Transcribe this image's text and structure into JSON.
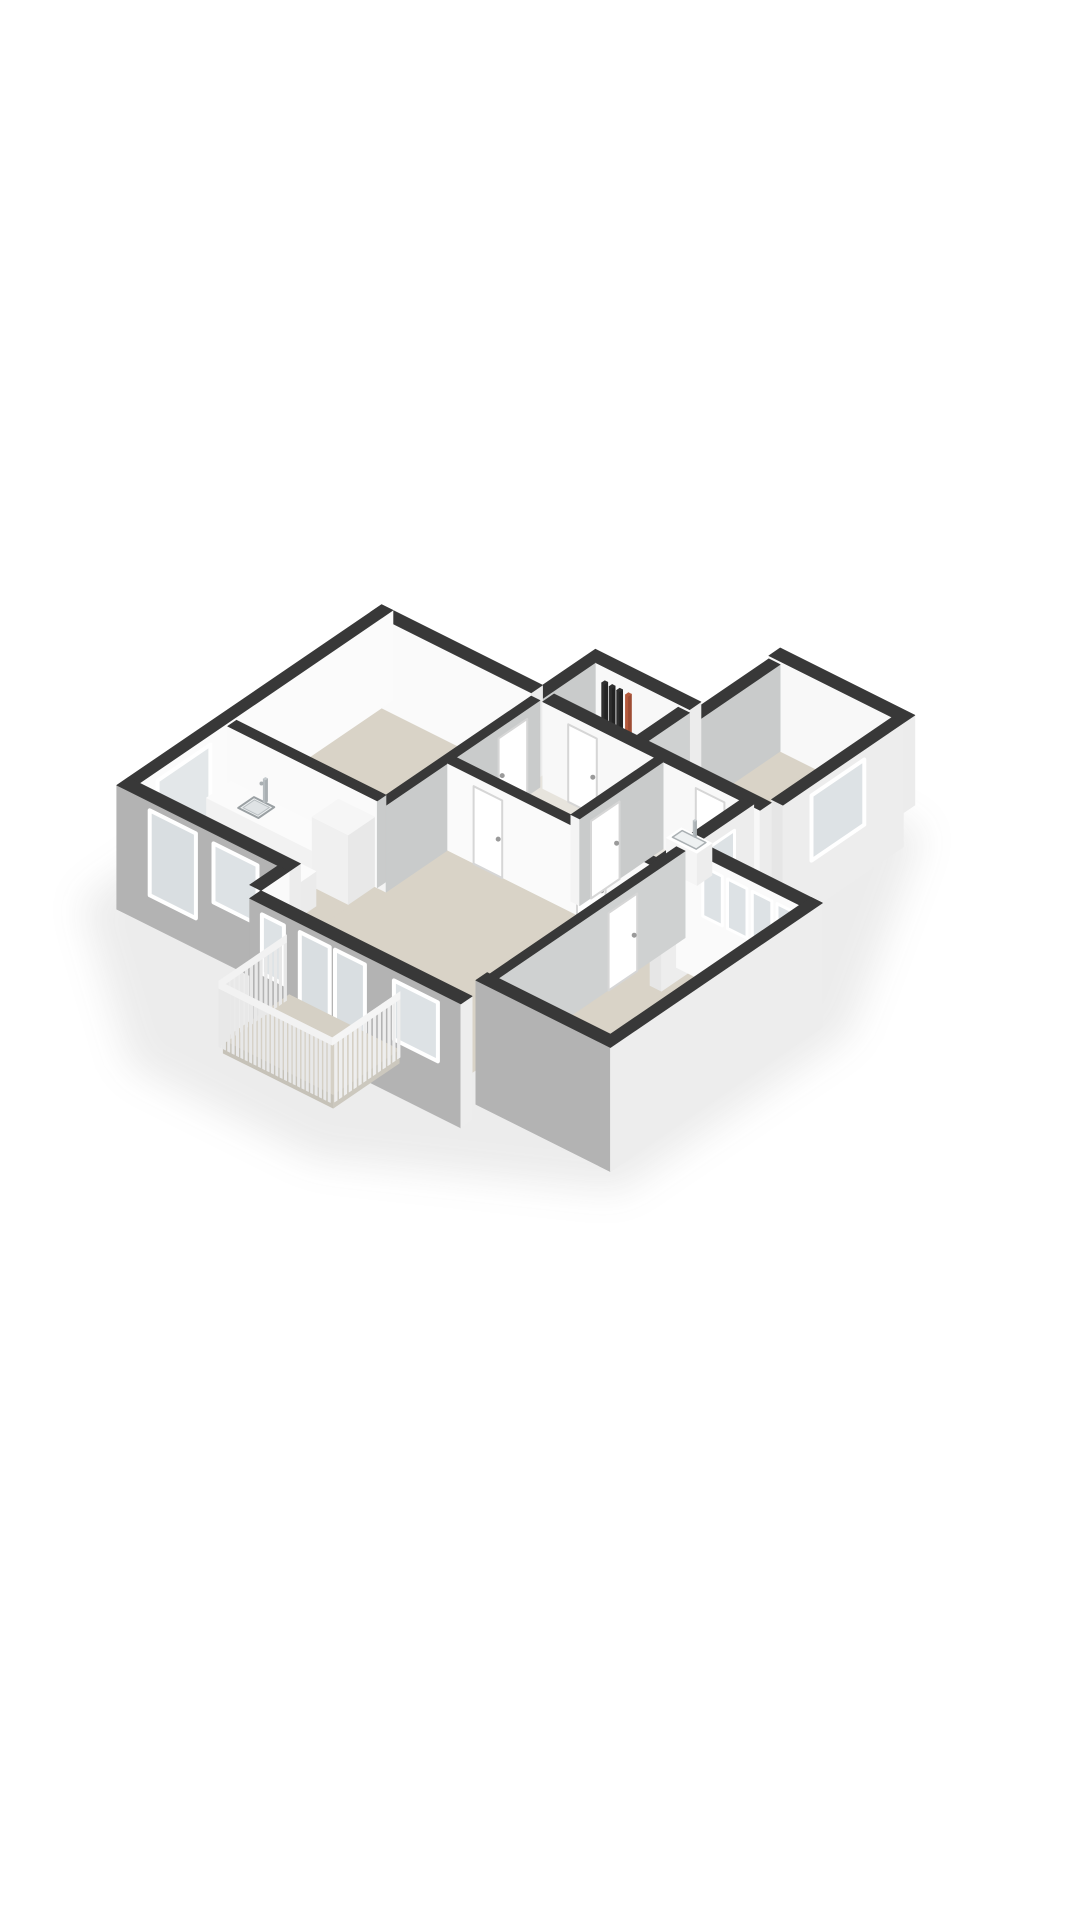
{
  "meta": {
    "description": "3D isometric cut-away floor plan render of an apartment, no text labels",
    "background": "#ffffff",
    "palette": {
      "wall_top": "#383838",
      "facade_south": "#b3b3b3",
      "facade_east": "#ededed",
      "interior_white": "#fafafa",
      "interior_gray": "#c9cbcb",
      "floor_beige": "#d9d3c7",
      "floor_light": "#e7e4dd",
      "glass": "#dde2e5",
      "cooktop": "#1e1e1e",
      "pipe_dark": "#2e2e2e",
      "pipe_orange": "#b3593c"
    }
  },
  "scene": {
    "projection": {
      "kx": 44,
      "ax": 22,
      "by": 30,
      "hz": 62,
      "ox": 100,
      "oy": 900
    },
    "items": [
      {
        "t": "poly",
        "n": "ground-shadow",
        "z": -0.5,
        "cls": "blur",
        "fill": "rgba(70,70,70,0.10)",
        "pts": [
          [
            -0.8,
            0.4
          ],
          [
            3.0,
            -2.3
          ],
          [
            7.2,
            -2.3
          ],
          [
            11.8,
            0.0
          ],
          [
            11.8,
            5.2
          ],
          [
            8.9,
            9.8
          ],
          [
            5.5,
            9.8
          ],
          [
            -0.8,
            7.0
          ]
        ]
      },
      {
        "t": "rect",
        "n": "floor-bedroom-left",
        "x1": 0,
        "y1": 2.9,
        "x2": 3.4,
        "y2": 6.4,
        "z": 0,
        "fill": "#d9d3c7"
      },
      {
        "t": "rect",
        "n": "floor-kitchen",
        "x1": 0,
        "y1": 0.9,
        "x2": 3.4,
        "y2": 2.9,
        "z": 0,
        "fill": "#d9d3c7"
      },
      {
        "t": "rect",
        "n": "floor-living-room",
        "x1": 3.4,
        "y1": 0,
        "x2": 8.2,
        "y2": 4.3,
        "z": 0,
        "fill": "#d9d3c7"
      },
      {
        "t": "rect",
        "n": "floor-hallway",
        "x1": 3.4,
        "y1": 4.3,
        "x2": 8.2,
        "y2": 6.4,
        "z": 0,
        "fill": "#e7e4dd"
      },
      {
        "t": "rect",
        "n": "floor-utility",
        "x1": 3.4,
        "y1": 6.4,
        "x2": 5.6,
        "y2": 7.6,
        "z": 0,
        "fill": "#e7e4dd"
      },
      {
        "t": "rect",
        "n": "floor-study",
        "x1": 5.8,
        "y1": 6.4,
        "x2": 8.6,
        "y2": 9.4,
        "z": 0,
        "fill": "#d9d3c7"
      },
      {
        "t": "rect",
        "n": "floor-bedroom-right",
        "x1": 8.2,
        "y1": 0.6,
        "x2": 11.0,
        "y2": 4.9,
        "z": 0,
        "fill": "#d9d3c7"
      },
      {
        "t": "box",
        "n": "wall-study-north",
        "x1": 5.8,
        "y1": 9.4,
        "x2": 8.86,
        "y2": 9.66,
        "z1": 0,
        "z2": 1.45,
        "cS": "#f8f8f8",
        "cE": "#ececec"
      },
      {
        "t": "box",
        "n": "wall-study-east",
        "x1": 8.6,
        "y1": 6.66,
        "x2": 8.86,
        "y2": 9.4,
        "z1": -0.55,
        "z2": 1.45,
        "cS": "#e6e6e6",
        "cE": "#ededed"
      },
      {
        "t": "face",
        "n": "window-study",
        "face": "E",
        "x": 8.87,
        "a1": 7.3,
        "a2": 8.5,
        "z1": 0.25,
        "z2": 1.3,
        "fill": "#dde2e5",
        "stroke": "#ffffff",
        "sw": 4
      },
      {
        "t": "box",
        "n": "wall-study-west",
        "x1": 5.8,
        "y1": 6.66,
        "x2": 6.06,
        "y2": 9.4,
        "z1": 0,
        "z2": 1.4,
        "cS": null,
        "cE": "#c9cbcb"
      },
      {
        "t": "box",
        "n": "wall-utility-north",
        "x1": 3.4,
        "y1": 7.6,
        "x2": 5.8,
        "y2": 7.86,
        "z1": 0,
        "z2": 1.45,
        "cS": "#f8f8f8",
        "cE": "#ececec"
      },
      {
        "t": "box",
        "n": "wall-utility-west",
        "x1": 3.4,
        "y1": 6.4,
        "x2": 3.66,
        "y2": 7.6,
        "z1": 0,
        "z2": 1.45,
        "cS": null,
        "cE": "#c9cbcb"
      },
      {
        "t": "box",
        "n": "wall-utility-east",
        "x1": 5.54,
        "y1": 6.4,
        "x2": 5.8,
        "y2": 7.6,
        "z1": 0,
        "z2": 1.4,
        "cS": "#f4f4f4",
        "cE": "#cfd1d1"
      },
      {
        "t": "box",
        "n": "radiator-pipe-1",
        "x1": 3.95,
        "y1": 7.45,
        "x2": 4.02,
        "y2": 7.52,
        "z1": 0,
        "z2": 1.3,
        "cS": "#2e2e2e",
        "cE": "#232323",
        "cT": "#2e2e2e"
      },
      {
        "t": "box",
        "n": "radiator-pipe-2",
        "x1": 4.12,
        "y1": 7.45,
        "x2": 4.19,
        "y2": 7.52,
        "z1": 0,
        "z2": 1.3,
        "cS": "#2e2e2e",
        "cE": "#232323",
        "cT": "#2e2e2e"
      },
      {
        "t": "box",
        "n": "radiator-pipe-3",
        "x1": 4.29,
        "y1": 7.45,
        "x2": 4.36,
        "y2": 7.52,
        "z1": 0,
        "z2": 1.3,
        "cS": "#2e2e2e",
        "cE": "#232323",
        "cT": "#2e2e2e"
      },
      {
        "t": "box",
        "n": "radiator-pipe-orange",
        "x1": 4.49,
        "y1": 7.45,
        "x2": 4.56,
        "y2": 7.52,
        "z1": 0,
        "z2": 1.3,
        "cS": "#b3593c",
        "cE": "#9e4c33",
        "cT": "#b3593c"
      },
      {
        "t": "box",
        "n": "wall-bedroom-left-north",
        "x1": -0.26,
        "y1": 6.4,
        "x2": 3.4,
        "y2": 6.66,
        "z1": 0,
        "z2": 1.45,
        "cS": "#fafafa",
        "cE": "#ececec"
      },
      {
        "t": "box",
        "n": "wall-west-exterior",
        "x1": -0.26,
        "y1": 0.9,
        "x2": 0,
        "y2": 6.66,
        "z1": 0,
        "z2": 1.45,
        "cS": "#b3b3b3",
        "cE": "#fbfbfb"
      },
      {
        "t": "face",
        "n": "window-kitchen-west",
        "face": "E",
        "x": 0.01,
        "a1": 1.3,
        "a2": 2.5,
        "z1": 0.05,
        "z2": 1.3,
        "fill": "#e3e7e9",
        "stroke": "#ffffff",
        "sw": 4
      },
      {
        "t": "box",
        "n": "wall-hallway-north",
        "x1": 3.66,
        "y1": 6.4,
        "x2": 6.06,
        "y2": 6.66,
        "z1": 0,
        "z2": 1.4,
        "cS": "#f8f8f8",
        "cE": "#ececec"
      },
      {
        "t": "face",
        "n": "door-utility",
        "face": "S",
        "y": 6.39,
        "a1": 4.25,
        "a2": 4.9,
        "z1": 0,
        "z2": 1.25,
        "fill": "#ffffff",
        "stroke": "#d6d6d6",
        "sw": 2
      },
      {
        "t": "dot",
        "n": "door-handle-utility",
        "x": 4.84,
        "y": 6.36,
        "z": 0.62,
        "r": 2.5,
        "fill": "#9a9a9a"
      },
      {
        "t": "box",
        "n": "wall-study-south",
        "x1": 6.06,
        "y1": 6.4,
        "x2": 8.6,
        "y2": 6.66,
        "z1": 0,
        "z2": 1.4,
        "cS": "#f8f8f8",
        "cE": "#ececec"
      },
      {
        "t": "face",
        "n": "door-study",
        "face": "S",
        "y": 6.39,
        "a1": 7.15,
        "a2": 7.8,
        "z1": 0,
        "z2": 1.25,
        "fill": "#ffffff",
        "stroke": "#d6d6d6",
        "sw": 2
      },
      {
        "t": "dot",
        "n": "door-handle-study",
        "x": 7.74,
        "y": 6.36,
        "z": 0.62,
        "r": 2.5,
        "fill": "#9a9a9a"
      },
      {
        "t": "box",
        "n": "wall-bathroom-east",
        "x1": 8.2,
        "y1": 4.3,
        "x2": 8.46,
        "y2": 6.4,
        "z1": -0.55,
        "z2": 1.45,
        "cS": "#e6e6e6",
        "cE": "#ededed"
      },
      {
        "t": "face",
        "n": "window-bathroom",
        "face": "E",
        "x": 8.47,
        "a1": 5.35,
        "a2": 5.95,
        "z1": 0.55,
        "z2": 1.25,
        "fill": "#dde2e5",
        "stroke": "#ffffff",
        "sw": 3
      },
      {
        "t": "box",
        "n": "wall-bedroom-right-north",
        "x1": 8.2,
        "y1": 4.9,
        "x2": 11.26,
        "y2": 5.16,
        "z1": -0.55,
        "z2": 1.45,
        "cS": "#fafafa",
        "cE": "#ededed"
      },
      {
        "t": "panes",
        "n": "window-band-bedroom-right",
        "face": "S",
        "y": 4.89,
        "a1": 8.75,
        "a2": 11.0,
        "z1": 0.5,
        "z2": 1.3,
        "np": 4,
        "fill": "#dde2e5",
        "stroke": "#ffffff",
        "sw": 3
      },
      {
        "t": "box",
        "n": "wall-bedroom-left-east",
        "x1": 3.4,
        "y1": 2.9,
        "x2": 3.6,
        "y2": 6.4,
        "z1": 0,
        "z2": 1.4,
        "cS": "#f4f4f4",
        "cE": "#c9cbcb"
      },
      {
        "t": "face",
        "n": "door-bedroom-left",
        "face": "E",
        "x": 3.61,
        "a1": 5.45,
        "a2": 6.1,
        "z1": 0,
        "z2": 1.25,
        "fill": "#ffffff",
        "stroke": "#d6d6d6",
        "sw": 2
      },
      {
        "t": "dot",
        "n": "door-handle-bedroom-left",
        "x": 3.62,
        "y": 5.52,
        "z": 0.62,
        "r": 2.5,
        "fill": "#9a9a9a"
      },
      {
        "t": "box",
        "n": "wall-kitchen-north",
        "x1": 0,
        "y1": 2.9,
        "x2": 3.4,
        "y2": 3.1,
        "z1": 0,
        "z2": 1.4,
        "cS": "#fafafa",
        "cE": "#c9cbcb"
      },
      {
        "t": "box",
        "n": "kitchen-counter",
        "x1": 0.1,
        "y1": 2.32,
        "x2": 3.12,
        "y2": 2.88,
        "z1": 0,
        "z2": 0.56,
        "cS": "#f2f2f2",
        "cE": "#ededed",
        "cT": "#fbfbfb"
      },
      {
        "t": "poly",
        "n": "kitchen-sink",
        "z": 0.57,
        "fill": "#eef1f2",
        "stroke": "#9aa0a3",
        "sw": 2,
        "pts": [
          [
            0.72,
            2.42
          ],
          [
            1.18,
            2.42
          ],
          [
            1.18,
            2.78
          ],
          [
            0.72,
            2.78
          ]
        ]
      },
      {
        "t": "poly",
        "n": "kitchen-sink-basin",
        "z": 0.57,
        "fill": "#dfe3e5",
        "stroke": "#b9bfc2",
        "sw": 1,
        "pts": [
          [
            0.78,
            2.47
          ],
          [
            1.12,
            2.47
          ],
          [
            1.12,
            2.73
          ],
          [
            0.78,
            2.73
          ]
        ]
      },
      {
        "t": "box",
        "n": "kitchen-faucet",
        "x1": 0.92,
        "y1": 2.79,
        "x2": 0.97,
        "y2": 2.84,
        "z1": 0.56,
        "z2": 0.93,
        "cS": "#b6bcbf",
        "cE": "#a9afb2",
        "cT": "#c5cbce"
      },
      {
        "t": "dot",
        "n": "kitchen-faucet-spout",
        "x": 0.95,
        "y": 2.72,
        "z": 0.9,
        "r": 2,
        "fill": "#a9afb2"
      },
      {
        "t": "box",
        "n": "kitchen-tall-cabinet",
        "x1": 2.52,
        "y1": 2.3,
        "x2": 3.34,
        "y2": 2.9,
        "z1": 0,
        "z2": 1.12,
        "cS": "#f0f0f0",
        "cE": "#e8e8e8",
        "cT": "#f6f6f6"
      },
      {
        "t": "box",
        "n": "kitchen-island",
        "x1": 1.0,
        "y1": 1.28,
        "x2": 2.95,
        "y2": 1.96,
        "z1": 0,
        "z2": 0.56,
        "cS": "#f2f2f2",
        "cE": "#ebebeb",
        "cT": "#fbfbfb"
      },
      {
        "t": "poly",
        "n": "cooktop",
        "z": 0.57,
        "fill": "#1e1e1e",
        "pts": [
          [
            1.45,
            1.4
          ],
          [
            2.12,
            1.4
          ],
          [
            2.12,
            1.84
          ],
          [
            1.45,
            1.84
          ]
        ]
      },
      {
        "t": "dot",
        "n": "cooktop-burner-1",
        "x": 1.6,
        "y": 1.52,
        "z": 0.57,
        "r": 4,
        "fill": "#454545"
      },
      {
        "t": "dot",
        "n": "cooktop-burner-2",
        "x": 1.6,
        "y": 1.73,
        "z": 0.57,
        "r": 4,
        "fill": "#454545"
      },
      {
        "t": "dot",
        "n": "cooktop-burner-3",
        "x": 1.95,
        "y": 1.52,
        "z": 0.57,
        "r": 4,
        "fill": "#454545"
      },
      {
        "t": "dot",
        "n": "cooktop-burner-4",
        "x": 1.95,
        "y": 1.73,
        "z": 0.57,
        "r": 4,
        "fill": "#454545"
      },
      {
        "t": "box",
        "n": "wall-hallway-south",
        "x1": 3.6,
        "y1": 4.3,
        "x2": 8.2,
        "y2": 4.5,
        "z1": 0,
        "z2": 1.4,
        "cS": "#fafafa",
        "cE": "#c9cbcb"
      },
      {
        "t": "face",
        "n": "door-living-1",
        "face": "S",
        "y": 4.29,
        "a1": 4.2,
        "a2": 4.85,
        "z1": 0,
        "z2": 1.25,
        "fill": "#ffffff",
        "stroke": "#d6d6d6",
        "sw": 2
      },
      {
        "t": "dot",
        "n": "door-handle-living-1",
        "x": 4.79,
        "y": 4.26,
        "z": 0.62,
        "r": 2.5,
        "fill": "#9a9a9a"
      },
      {
        "t": "face",
        "n": "door-living-2",
        "face": "S",
        "y": 4.29,
        "a1": 6.55,
        "a2": 7.2,
        "z1": 0,
        "z2": 1.25,
        "fill": "#ffffff",
        "stroke": "#d6d6d6",
        "sw": 2
      },
      {
        "t": "dot",
        "n": "door-handle-living-2",
        "x": 7.14,
        "y": 4.26,
        "z": 0.62,
        "r": 2.5,
        "fill": "#9a9a9a"
      },
      {
        "t": "box",
        "n": "wall-bathroom-west",
        "x1": 6.2,
        "y1": 4.5,
        "x2": 6.4,
        "y2": 6.4,
        "z1": 0,
        "z2": 1.4,
        "cS": "#f4f4f4",
        "cE": "#c9cbcb"
      },
      {
        "t": "face",
        "n": "door-bathroom",
        "face": "E",
        "x": 6.41,
        "a1": 4.75,
        "a2": 5.4,
        "z1": 0,
        "z2": 1.25,
        "fill": "#ffffff",
        "stroke": "#d6d6d6",
        "sw": 2
      },
      {
        "t": "dot",
        "n": "door-handle-bathroom",
        "x": 6.42,
        "y": 5.32,
        "z": 0.62,
        "r": 2.5,
        "fill": "#9a9a9a"
      },
      {
        "t": "box",
        "n": "bathroom-sink",
        "x1": 6.85,
        "y1": 6.02,
        "x2": 7.55,
        "y2": 6.36,
        "z1": 0,
        "z2": 0.52,
        "cS": "#f5f5f5",
        "cE": "#ededed",
        "cT": "#ffffff"
      },
      {
        "t": "poly",
        "n": "bathroom-sink-basin",
        "z": 0.53,
        "fill": "#eef1f2",
        "stroke": "#aab0b3",
        "sw": 1.5,
        "pts": [
          [
            6.93,
            6.08
          ],
          [
            7.47,
            6.08
          ],
          [
            7.47,
            6.3
          ],
          [
            6.93,
            6.3
          ]
        ]
      },
      {
        "t": "box",
        "n": "bathroom-faucet",
        "x1": 7.18,
        "y1": 6.3,
        "x2": 7.22,
        "y2": 6.34,
        "z1": 0.52,
        "z2": 0.78,
        "cS": "#b6bcbf",
        "cE": "#a9afb2",
        "cT": "#c5cbce"
      },
      {
        "t": "box",
        "n": "wall-bedroom-right-west",
        "x1": 8.2,
        "y1": 0.6,
        "x2": 8.4,
        "y2": 4.9,
        "z1": 0,
        "z2": 1.4,
        "cS": "#f4f4f4",
        "cE": "#cfd1d1"
      },
      {
        "t": "face",
        "n": "door-bedroom-right",
        "face": "E",
        "x": 8.41,
        "a1": 3.15,
        "a2": 3.8,
        "z1": 0,
        "z2": 1.25,
        "fill": "#ffffff",
        "stroke": "#d6d6d6",
        "sw": 2
      },
      {
        "t": "dot",
        "n": "door-handle-bedroom-right",
        "x": 8.42,
        "y": 3.72,
        "z": 0.62,
        "r": 2.5,
        "fill": "#9a9a9a"
      },
      {
        "t": "box",
        "n": "wall-bedroom-right-south",
        "x1": 8.2,
        "y1": 0.34,
        "x2": 11.26,
        "y2": 0.6,
        "z1": -0.55,
        "z2": 1.45,
        "cS": "#b3b3b3",
        "cE": "#ededed"
      },
      {
        "t": "box",
        "n": "wall-bedroom-right-east",
        "x1": 11.0,
        "y1": 0.34,
        "x2": 11.26,
        "y2": 5.16,
        "z1": -0.55,
        "z2": 1.45,
        "cS": "#b3b3b3",
        "cE": "#ededed"
      },
      {
        "t": "box",
        "n": "wall-kitchen-south",
        "x1": -0.26,
        "y1": 0.64,
        "x2": 3.66,
        "y2": 0.9,
        "z1": -0.55,
        "z2": 1.45,
        "cS": "#b3b3b3",
        "cE": "#ececec"
      },
      {
        "t": "face",
        "n": "glass-door-kitchen",
        "face": "S",
        "y": 0.63,
        "a1": 0.5,
        "a2": 1.55,
        "z1": -0.05,
        "z2": 1.32,
        "fill": "#d9dee1",
        "stroke": "#ffffff",
        "sw": 4
      },
      {
        "t": "face",
        "n": "window-kitchen-south",
        "face": "S",
        "y": 0.63,
        "a1": 1.95,
        "a2": 2.95,
        "z1": 0.35,
        "z2": 1.3,
        "fill": "#dde2e5",
        "stroke": "#ffffff",
        "sw": 4
      },
      {
        "t": "box",
        "n": "wall-living-west-step",
        "x1": 3.4,
        "y1": 0,
        "x2": 3.66,
        "y2": 0.64,
        "z1": -0.55,
        "z2": 1.45,
        "cS": null,
        "cE": "#fafafa"
      },
      {
        "t": "box",
        "n": "wall-living-south",
        "x1": 3.66,
        "y1": -0.26,
        "x2": 8.46,
        "y2": 0,
        "z1": -0.55,
        "z2": 1.45,
        "cS": "#b3b3b3",
        "cE": "#ededed"
      },
      {
        "t": "face",
        "n": "window-living-west",
        "face": "S",
        "y": -0.27,
        "a1": 3.95,
        "a2": 4.45,
        "z1": 0.35,
        "z2": 1.3,
        "fill": "#dde2e5",
        "stroke": "#ffffff",
        "sw": 4
      },
      {
        "t": "panes",
        "n": "french-doors-balcony",
        "face": "S",
        "y": -0.27,
        "a1": 4.75,
        "a2": 6.35,
        "z1": -0.25,
        "z2": 1.32,
        "np": 2,
        "fill": "#d9dee1",
        "stroke": "#ffffff",
        "sw": 4
      },
      {
        "t": "face",
        "n": "window-living-east",
        "face": "S",
        "y": -0.27,
        "a1": 6.95,
        "a2": 7.95,
        "z1": 0.35,
        "z2": 1.3,
        "fill": "#dde2e5",
        "stroke": "#ffffff",
        "sw": 4
      },
      {
        "t": "box",
        "n": "balcony-floor",
        "x1": 4.3,
        "y1": -1.5,
        "x2": 6.8,
        "y2": 0,
        "z1": -0.22,
        "z2": 0,
        "cS": "#c6c2b8",
        "cE": "#ccc8be",
        "cT": "#d5d0c5"
      },
      {
        "t": "slats",
        "n": "balcony-railing-west",
        "p1": [
          4.26,
          -0.02
        ],
        "p2": [
          4.26,
          -1.56
        ],
        "z1": -0.1,
        "z2": 0.84,
        "nslat": 14,
        "fill": "#e8e8e8",
        "rail": "#f2f2f2"
      },
      {
        "t": "slats",
        "n": "balcony-railing-south",
        "p1": [
          4.26,
          -1.56
        ],
        "p2": [
          6.84,
          -1.56
        ],
        "z1": -0.1,
        "z2": 0.84,
        "nslat": 26,
        "fill": "#e8e8e8",
        "rail": "#f2f2f2"
      },
      {
        "t": "slats",
        "n": "balcony-railing-east",
        "p1": [
          6.84,
          -0.02
        ],
        "p2": [
          6.84,
          -1.56
        ],
        "z1": -0.1,
        "z2": 0.84,
        "nslat": 14,
        "fill": "#eeeeee",
        "rail": "#f5f5f5"
      }
    ]
  }
}
